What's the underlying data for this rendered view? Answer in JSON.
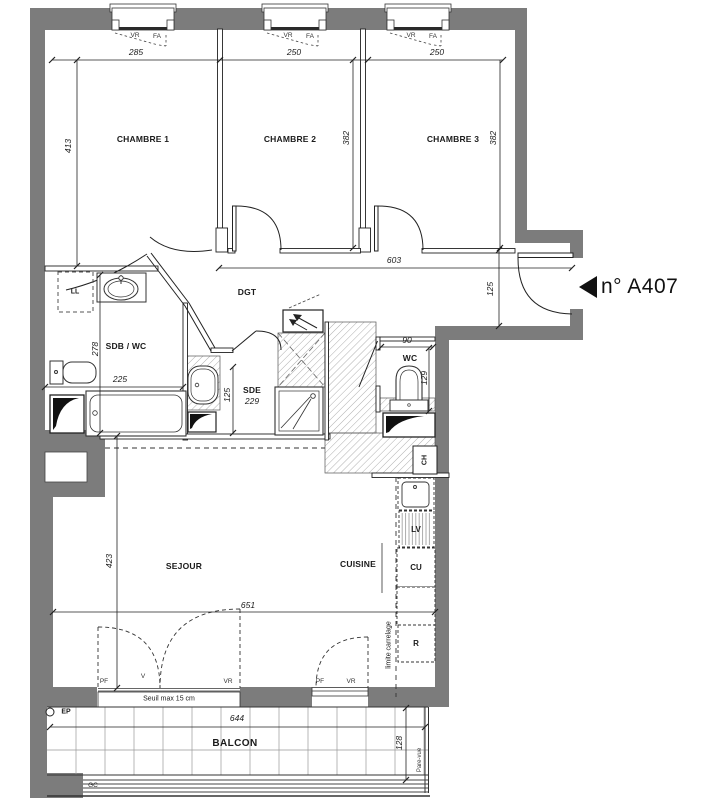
{
  "title": "n° A407",
  "rooms": {
    "chambre1": "CHAMBRE 1",
    "chambre2": "CHAMBRE 2",
    "chambre3": "CHAMBRE 3",
    "dgt": "DGT",
    "sdb": "SDB / WC",
    "sde": "SDE",
    "wc": "WC",
    "sejour": "SEJOUR",
    "cuisine": "CUISINE",
    "balcon": "BALCON"
  },
  "dimensions": {
    "ch1_width": "285",
    "ch2_width": "250",
    "ch3_width": "250",
    "ch1_depth": "413",
    "ch2_depth": "382",
    "ch3_depth": "382",
    "dgt_length": "603",
    "entry_width": "125",
    "sdb_depth": "278",
    "sdb_width": "225",
    "sde_area": "229",
    "sde_width": "125",
    "wc_width": "90",
    "wc_depth": "129",
    "sejour_depth": "423",
    "sejour_width": "651",
    "balcon_width": "644",
    "balcon_depth": "128"
  },
  "fixtures": {
    "ll": "LL",
    "ch": "CH",
    "cu": "CU",
    "lv": "LV",
    "r": "R",
    "ep": "EP",
    "gc": "GC"
  },
  "annotations": {
    "vr": "VR",
    "fa": "FA",
    "pf": "PF",
    "v": "V",
    "seuil": "Seuil max 15 cm",
    "limite": "limite carrelage",
    "pare_vue": "Pare-vue"
  },
  "colors": {
    "wall": "#7c7c7c",
    "line": "#222222"
  }
}
